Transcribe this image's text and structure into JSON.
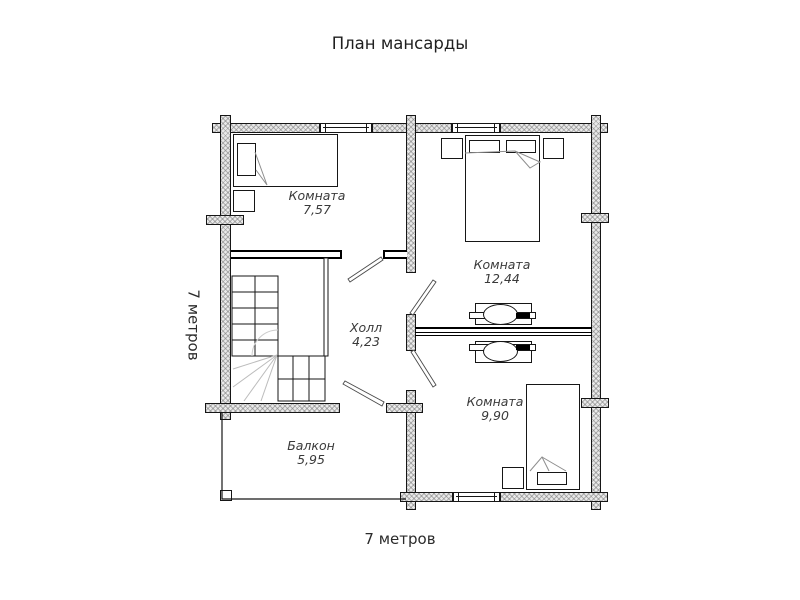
{
  "title": "План мансарды",
  "dimensions": {
    "bottom_label": "7 метров",
    "left_label": "7 метров"
  },
  "rooms": [
    {
      "id": "room-1",
      "name": "Комната",
      "area": "7,57"
    },
    {
      "id": "room-2",
      "name": "Комната",
      "area": "12,44"
    },
    {
      "id": "hall",
      "name": "Холл",
      "area": "4,23"
    },
    {
      "id": "room-3",
      "name": "Комната",
      "area": "9,90"
    },
    {
      "id": "balcony",
      "name": "Балкон",
      "area": "5,95"
    }
  ],
  "colors": {
    "wall_fill": "#e9e9e9",
    "wall_hatch": "#8c8c8c",
    "line": "#161616",
    "light_line": "#bcbcbc",
    "text": "#2b2b2b"
  }
}
